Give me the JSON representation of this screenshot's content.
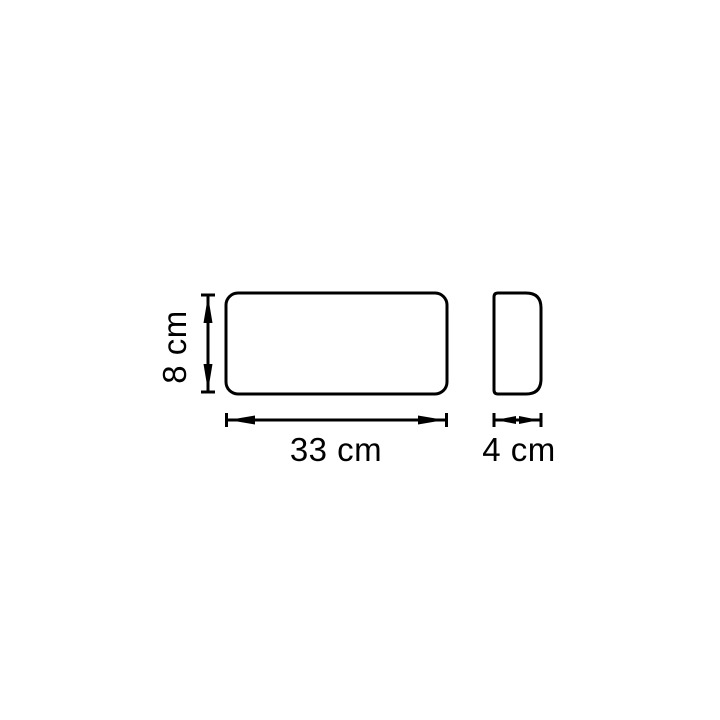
{
  "drawing": {
    "type": "technical-dimension-drawing",
    "unit": "cm",
    "colors": {
      "line": "#000000",
      "background": "#ffffff"
    },
    "views": {
      "front": {
        "name": "front-view",
        "shape": "rounded-rectangle"
      },
      "side": {
        "name": "side-view",
        "shape": "rounded-rectangle-asymmetric"
      }
    },
    "dimensions": {
      "height": {
        "value": 8,
        "label": "8 cm"
      },
      "width": {
        "value": 33,
        "label": "33 cm"
      },
      "depth": {
        "value": 4,
        "label": "4 cm"
      }
    }
  }
}
